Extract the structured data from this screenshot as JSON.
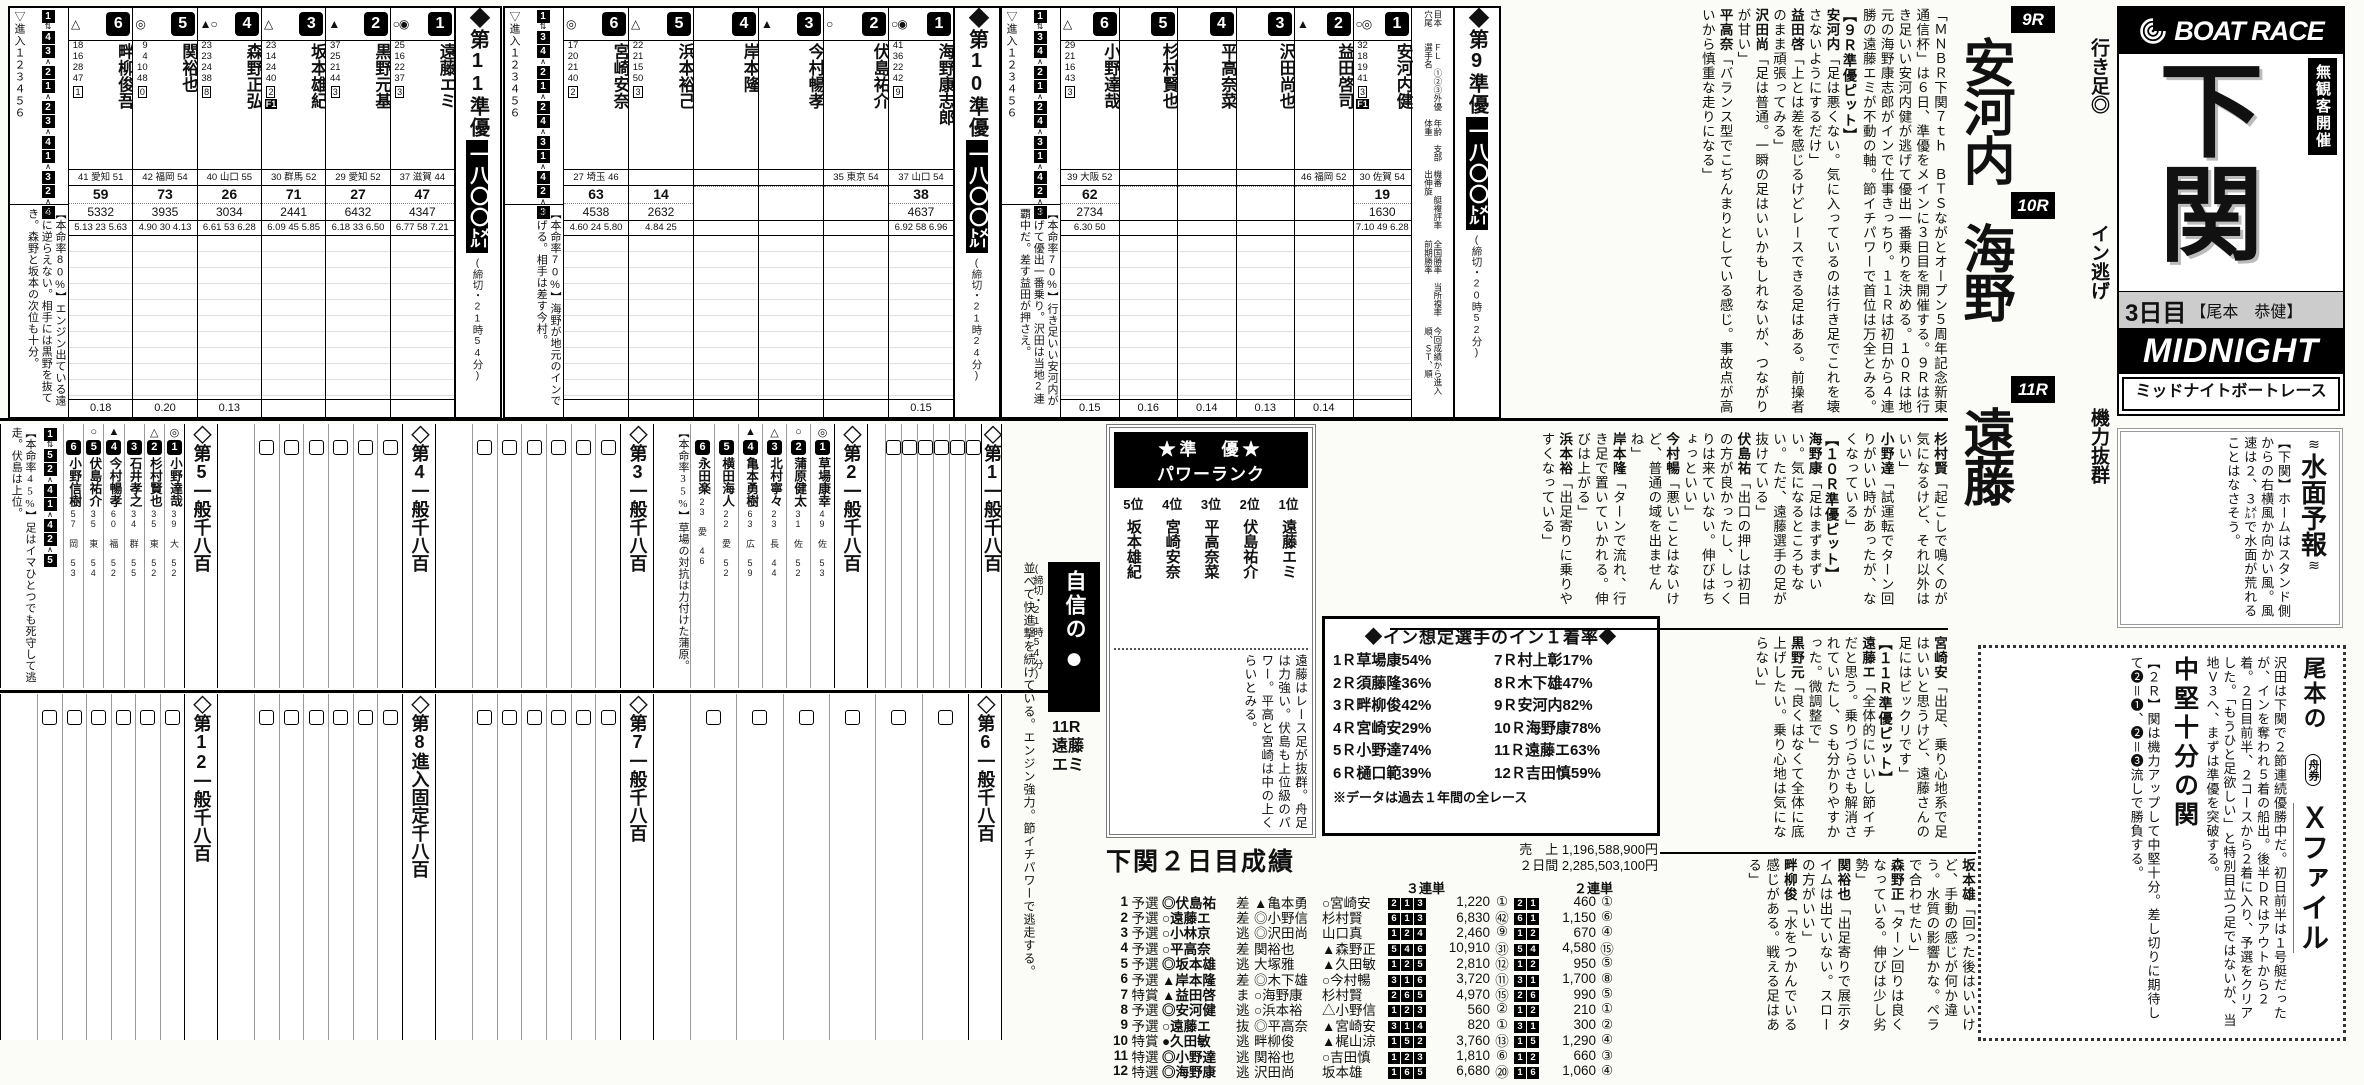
{
  "masthead": {
    "brand": "BOAT RACE",
    "closed_door": "無観客開催",
    "venue": "下関",
    "day": "3日目",
    "byline": "【尾本　恭健】",
    "midnight": "MIDNIGHT",
    "midnight_kana": "ミッドナイトボートレース"
  },
  "headline": {
    "items": [
      {
        "race": "9R",
        "label": "行き足◎",
        "name": "安河内"
      },
      {
        "race": "10R",
        "label": "イン逃げ",
        "name": "海野"
      },
      {
        "race": "11R",
        "label": "機力抜群",
        "name": "遠藤"
      }
    ]
  },
  "lede": "「ＭＮＢＲ下関７ｔｈ　ＢＴＳながとオープン５周年記念新東通信杯」は６日、準優をメインに３日目を開催する。９Ｒは行き足いい安河内健が逃げて優出一番乗りを決める。１０Ｒは地元の海野康志郎がインで仕事きっちり。１１Ｒは初日から４連勝の遠藤エミが不動の軸。節イチパワーで首位は万全とみる。",
  "pit_bands": [
    {
      "items": [
        {
          "q": "lede"
        },
        {
          "h": "【９Ｒ準優ピット】"
        },
        {
          "q": "安河内「足は悪くない。気に入っているのは行き足でこれを壊さないようにするだけ」"
        },
        {
          "q": "益田啓「上とは差を感じるけどレースできる足はある。前操者のまま頑張ってみる」"
        },
        {
          "q": "沢田尚「足は普通。一瞬の足はいいかもしれないが、つながりが甘い」"
        },
        {
          "q": "平高奈「バランス型でこぢんまりとしている感じ。事故点が高いから慎重な走りになる」"
        }
      ]
    },
    {
      "items": [
        {
          "q": "杉村賢「起こしで鳴くのが気になるけど、それ以外はいい」"
        },
        {
          "q": "小野達「試運転でターン回りがいい時があったが、なくなっている」"
        },
        {
          "h": "【１０Ｒ準優ピット】"
        },
        {
          "q": "海野康「足はまずまずいい。気になるところもない。ただ、遠藤選手の足が抜けている」"
        },
        {
          "q": "伏島祐「出口の押しは初日の方が良かったし、しっくりは来ていない。伸びはちょっといい」"
        },
        {
          "q": "今村暢「悪いことはないけど、普通の域を出ませんね」"
        },
        {
          "q": "岸本隆「ターンで流れ、行き足で置いていかれる。伸びは上がる」"
        },
        {
          "q": "浜本裕「出足寄りに乗りやすくなっている」"
        }
      ]
    },
    {
      "items": [
        {
          "q": "宮崎安「出足、乗り心地系で足はいいと思うけど、遠藤さんの足にはビックリです」"
        },
        {
          "h": "【１１Ｒ準優ピット】"
        },
        {
          "q": "遠藤エ「全体的にいいし節イチだと思う。乗りづらさも解消されていたし、Ｓも分かりやすかった。微調整で」"
        },
        {
          "q": "黒野元「良くはなくて全体に底上げしたい。乗り心地は気にならない」"
        }
      ]
    },
    {
      "items": [
        {
          "q": "坂本雄「回った後はいいけど、手動の感じが何か違う。水質の影響かな。ペラで合わせたい」"
        },
        {
          "q": "森野正「ターン回りは良くなっている。伸びは少し劣勢」"
        },
        {
          "q": "関裕也「出足寄りで展示タイムは出ていない。スローの方がいい」"
        },
        {
          "q": "畔柳俊「水をつかんでいる感じがある。戦える足はある」"
        }
      ]
    }
  ],
  "legend": [
    "目本　穴尾",
    "ＦＬ　①②③外優　選手名",
    "年齢　支部　体重",
    "機番　艇複評率　出伸旋",
    "全国勝率　当所複率　前期勝率",
    "今回成績から進入順、ＳＴ、順"
  ],
  "entry_label": "▽進入１２３４５６",
  "cards": [
    {
      "title": "◆第11準優",
      "dist": "一八〇〇㍍",
      "deadline": "(締切・21時54分)",
      "comment": "【本命率80%】エンジン出ている遠藤に逆らえない。相手には黒野を抜てき。森野と坂本の次位も十分。",
      "pairs": [
        [
          1,
          4
        ],
        [
          3,
          2
        ],
        [
          1,
          2
        ],
        [
          3,
          4
        ],
        [
          1,
          3
        ],
        [
          2,
          4
        ]
      ],
      "racers": [
        {
          "n": 6,
          "mk": "△",
          "nm": "畔柳俊吾",
          "rc": "18 16 28 47",
          "fl": "1",
          "info": "41 愛知 51",
          "s1": "59",
          "s2": "5332",
          "rt": "5.13 23 5.63",
          "st": "0.18"
        },
        {
          "n": 5,
          "mk": "◎",
          "nm": "関裕也",
          "rc": "9 4 10 48",
          "fl": "0",
          "info": "42 福岡 54",
          "s1": "73",
          "s2": "3935",
          "rt": "4.90 30 4.13",
          "st": "0.20"
        },
        {
          "n": 4,
          "mk": "▲○",
          "nm": "森野正弘",
          "rc": "23 23 24 38",
          "fl": "8",
          "info": "40 山口 55",
          "s1": "26",
          "s2": "3034",
          "rt": "6.61 53 6.28",
          "st": "0.13"
        },
        {
          "n": 3,
          "mk": "△",
          "nm": "坂本雄紀",
          "rc": "23 14 24 40",
          "fl": "2",
          "flag": "F1",
          "info": "30 群馬 52",
          "s1": "71",
          "s2": "2441",
          "rt": "6.09 45 5.85",
          "st": ""
        },
        {
          "n": 2,
          "mk": "▲",
          "nm": "黒野元基",
          "rc": "37 25 21 44",
          "fl": "3",
          "info": "29 愛知 52",
          "s1": "27",
          "s2": "6432",
          "rt": "6.18 33 6.50",
          "st": ""
        },
        {
          "n": 1,
          "mk": "○◉",
          "nm": "遠藤エミ",
          "rc": "25 16 22 37",
          "fl": "3",
          "info": "37 滋賀 44",
          "s1": "47",
          "s2": "4347",
          "rt": "6.77 58 7.21",
          "st": ""
        }
      ]
    },
    {
      "title": "◆第10準優",
      "dist": "一八〇〇㍍",
      "deadline": "(締切・21時24分)",
      "comment": "【本命率70%】海野が地元のインで逃げる。相手は差す今村。",
      "pairs": [
        [
          1,
          3
        ],
        [
          4,
          2
        ],
        [
          1,
          2
        ],
        [
          4,
          3
        ],
        [
          1,
          4
        ],
        [
          2,
          3
        ]
      ],
      "racers": [
        {
          "n": 6,
          "mk": "◎",
          "nm": "宮崎安奈",
          "rc": "17 20 21 40",
          "fl": "2",
          "info": "27 埼玉 46",
          "s1": "63",
          "s2": "4538",
          "rt": "4.60 24 5.80",
          "st": ""
        },
        {
          "n": 5,
          "mk": "△",
          "nm": "浜本裕己",
          "rc": "22 21 15 50",
          "fl": "3",
          "info": "",
          "s1": "14",
          "s2": "2632",
          "rt": "4.84 25",
          "st": ""
        },
        {
          "n": 4,
          "mk": "",
          "nm": "岸本隆",
          "rc": "",
          "fl": "",
          "info": "",
          "s1": "",
          "s2": "",
          "rt": "",
          "st": ""
        },
        {
          "n": 3,
          "mk": "▲",
          "nm": "今村暢孝",
          "rc": "",
          "fl": "",
          "info": "",
          "s1": "",
          "s2": "",
          "rt": "",
          "st": ""
        },
        {
          "n": 2,
          "mk": "○",
          "nm": "伏島祐介",
          "rc": "",
          "fl": "",
          "info": "35 東京 54",
          "s1": "",
          "s2": "",
          "rt": "",
          "st": ""
        },
        {
          "n": 1,
          "mk": "○◉",
          "nm": "海野康志郎",
          "rc": "41 36 22 42",
          "fl": "9",
          "info": "37 山口 54",
          "s1": "38",
          "s2": "4637",
          "rt": "6.92 58 6.96",
          "st": "0.15"
        }
      ]
    },
    {
      "title": "◆第9準優",
      "dist": "一八〇〇㍍",
      "deadline": "(締切・20時52分)",
      "comment": "【本命率70%】行き足いい安河内が逃げて優出一番乗り。沢田は当地2連覇中だ。差す益田が押さえ。",
      "pairs": [
        [
          1,
          3
        ],
        [
          4,
          2
        ],
        [
          1,
          2
        ],
        [
          4,
          3
        ],
        [
          1,
          4
        ],
        [
          2,
          3
        ]
      ],
      "racers": [
        {
          "n": 6,
          "mk": "△",
          "nm": "小野達哉",
          "rc": "29 21 16 43",
          "fl": "3",
          "info": "39 大阪 52",
          "s1": "62",
          "s2": "2734",
          "rt": "6.30 50",
          "st": "0.15"
        },
        {
          "n": 5,
          "mk": "",
          "nm": "杉村賢也",
          "rc": "",
          "fl": "",
          "info": "",
          "s1": "",
          "s2": "",
          "rt": "",
          "st": "0.16"
        },
        {
          "n": 4,
          "mk": "",
          "nm": "平高奈菜",
          "rc": "",
          "fl": "",
          "info": "",
          "s1": "",
          "s2": "",
          "rt": "",
          "st": "0.14"
        },
        {
          "n": 3,
          "mk": "",
          "nm": "沢田尚也",
          "rc": "",
          "fl": "",
          "info": "",
          "s1": "",
          "s2": "",
          "rt": "",
          "st": "0.13"
        },
        {
          "n": 2,
          "mk": "▲",
          "nm": "益田啓司",
          "rc": "",
          "fl": "",
          "info": "46 福岡 52",
          "s1": "",
          "s2": "",
          "rt": "",
          "st": "0.14"
        },
        {
          "n": 1,
          "mk": "○◎",
          "nm": "安河内健",
          "rc": "32 18 19 41",
          "fl": "3",
          "flag": "F1",
          "info": "30 佐賀 54",
          "s1": "19",
          "s2": "1630",
          "rt": "7.10 49 6.28",
          "st": ""
        }
      ]
    }
  ],
  "powerrank": {
    "title1": "★準　優★",
    "title2": "パワーランク",
    "entries": [
      {
        "rank": "1位",
        "name": "遠藤エミ"
      },
      {
        "rank": "2位",
        "name": "伏島祐介"
      },
      {
        "rank": "3位",
        "name": "平高奈菜"
      },
      {
        "rank": "4位",
        "name": "宮崎安奈"
      },
      {
        "rank": "5位",
        "name": "坂本雄紀"
      }
    ],
    "note": "遠藤はレース足が抜群。舟足は力強い。伏島も上位級のパワー。平高と宮崎は中の上くらいとみる。"
  },
  "inrate": {
    "title": "◆イン想定選手のイン１着率◆",
    "left": [
      "1Ｒ草場康54%",
      "2Ｒ須藤隆36%",
      "3Ｒ畔柳俊42%",
      "4Ｒ宮崎安29%",
      "5Ｒ小野達74%",
      "6Ｒ樋口範39%"
    ],
    "right": [
      "7Ｒ村上彰17%",
      "8Ｒ木下雄47%",
      "9Ｒ安河内82%",
      "10Ｒ海野康78%",
      "11Ｒ遠藤エ63%",
      "12Ｒ吉田慎59%"
    ],
    "note": "※データは過去１年間の全レース"
  },
  "results": {
    "title": "下関２日目成績",
    "sales": [
      "売　上 1,196,588,900円",
      "２日間 2,285,503,100円"
    ],
    "tan_label": "３連単",
    "ni_label": "２連単",
    "rows": [
      {
        "r": "1",
        "cls": "予選",
        "w1": "◎伏島祐",
        "k": "差",
        "w2": "▲亀本勇",
        "w3": "○宮崎安",
        "t": "2-1-3",
        "tp": "1,220",
        "tn": "①",
        "d": "2-1",
        "dp": "460",
        "dn": "①"
      },
      {
        "r": "2",
        "cls": "予選",
        "w1": "○遠藤エ",
        "k": "差",
        "w2": "◎小野信",
        "w3": "杉村賢",
        "t": "6-1-3",
        "tp": "6,830",
        "tn": "㊷",
        "d": "6-1",
        "dp": "1,150",
        "dn": "⑥"
      },
      {
        "r": "3",
        "cls": "予選",
        "w1": "○小林京",
        "k": "逃",
        "w2": "◎沢田尚",
        "w3": "山口真",
        "t": "1-2-4",
        "tp": "2,460",
        "tn": "⑨",
        "d": "1-2",
        "dp": "670",
        "dn": "④"
      },
      {
        "r": "4",
        "cls": "予選",
        "w1": "○平高奈",
        "k": "差",
        "w2": "関裕也",
        "w3": "▲森野正",
        "t": "5-4-6",
        "tp": "10,910",
        "tn": "㉛",
        "d": "5-4",
        "dp": "4,580",
        "dn": "⑮"
      },
      {
        "r": "5",
        "cls": "予選",
        "w1": "◎坂本雄",
        "k": "逃",
        "w2": "大塚雅",
        "w3": "▲久田敏",
        "t": "1-2-5",
        "tp": "2,810",
        "tn": "⑫",
        "d": "1-2",
        "dp": "950",
        "dn": "⑤"
      },
      {
        "r": "6",
        "cls": "予選",
        "w1": "▲岸本隆",
        "k": "差",
        "w2": "◎木下雄",
        "w3": "○今村暢",
        "t": "3-1-6",
        "tp": "3,720",
        "tn": "⑪",
        "d": "3-1",
        "dp": "1,700",
        "dn": "⑧"
      },
      {
        "r": "7",
        "cls": "特賞",
        "w1": "▲益田啓",
        "k": "ま",
        "w2": "○海野康",
        "w3": "杉村賢",
        "t": "2-6-5",
        "tp": "4,970",
        "tn": "⑮",
        "d": "2-6",
        "dp": "990",
        "dn": "⑤"
      },
      {
        "r": "8",
        "cls": "予選",
        "w1": "◎安河健",
        "k": "逃",
        "w2": "○浜本裕",
        "w3": "△小野信",
        "t": "1-2-3",
        "tp": "560",
        "tn": "②",
        "d": "1-2",
        "dp": "210",
        "dn": "①"
      },
      {
        "r": "9",
        "cls": "予選",
        "w1": "○遠藤エ",
        "k": "抜",
        "w2": "◎平高奈",
        "w3": "▲宮崎安",
        "t": "3-1-4",
        "tp": "820",
        "tn": "①",
        "d": "3-1",
        "dp": "300",
        "dn": "②"
      },
      {
        "r": "10",
        "cls": "特賞",
        "w1": "●久田敏",
        "k": "逃",
        "w2": "畔柳俊",
        "w3": "▲梶山涼",
        "t": "1-5-2",
        "tp": "3,760",
        "tn": "⑬",
        "d": "1-5",
        "dp": "1,290",
        "dn": "④"
      },
      {
        "r": "11",
        "cls": "特選",
        "w1": "◎小野達",
        "k": "逃",
        "w2": "関裕也",
        "w3": "○吉田慎",
        "t": "1-2-3",
        "tp": "1,810",
        "tn": "⑥",
        "d": "1-2",
        "dp": "660",
        "dn": "③"
      },
      {
        "r": "12",
        "cls": "特選",
        "w1": "◎海野康",
        "k": "逃",
        "w2": "沢田尚",
        "w3": "坂本雄",
        "t": "1-6-5",
        "tp": "6,680",
        "tn": "⑳",
        "d": "1-6",
        "dp": "1,060",
        "dn": "④"
      }
    ]
  },
  "forecast": {
    "title": "水面予報",
    "body": "【下関】ホームはスタンド側からの右横風か向かい風。風速は２、３㍍で水面が荒れることはなさそう。"
  },
  "xfile": {
    "author": "尾本の",
    "badge": "舟券",
    "title": "Ｘファイル",
    "body": "沢田は下関で２節連続優勝中だ。初日前半は１号艇だったが、インを奪われ５着の船出。後半ＤＲはアウトから２着。２日目前半、２コースから２着に入り、予選をクリアした。「もうひと足欲しい」と特別目立つ足ではないが、当地Ｖ３へ、まずは準優を突破する。",
    "subhead": "中堅十分の関",
    "body2": "【２Ｒ】関は機力アップして中堅十分。差し切りに期待して❷＝❶、❷＝❸流しで勝負する。"
  },
  "confidence": {
    "banner": "自信の",
    "mark": "●",
    "deadline": "(締切・21時54分)",
    "race": "11R",
    "name": "遠藤エミ",
    "body": "並べて快進撃を続けている。エンジン強力。節イチパワーで逃走する。"
  },
  "previews": [
    {
      "no": 5,
      "title": "◇第5一般千八百",
      "comment": "【本命率45%】足はイマひとつでも死守して逃走。伏島は上位。",
      "pairs": [
        [
          1,
          5
        ],
        [
          2,
          4
        ],
        [
          1,
          4
        ],
        [
          2,
          5
        ]
      ],
      "racers": [
        {
          "n": 1,
          "mk": "◎",
          "nm": "小野達哉",
          "info": "39 大 52"
        },
        {
          "n": 2,
          "mk": "△",
          "nm": "杉村賢也",
          "info": "35 東 52"
        },
        {
          "n": 3,
          "mk": "",
          "nm": "石井孝之",
          "info": "34 群 55"
        },
        {
          "n": 4,
          "mk": "▲",
          "nm": "今村暢孝",
          "info": "60 福 52"
        },
        {
          "n": 5,
          "mk": "○",
          "nm": "伏島祐介",
          "info": "35 東 54"
        },
        {
          "n": 6,
          "mk": "",
          "nm": "小野信樹",
          "info": "57 岡 53"
        }
      ]
    },
    {
      "no": 4,
      "title": "◇第4一般千八百"
    },
    {
      "no": 3,
      "title": "◇第3一般千八百"
    },
    {
      "no": 2,
      "title": "◇第2一般千八百",
      "comment": "【本命率35%】草場の対抗は力付けた蒲原。",
      "racers": [
        {
          "n": 1,
          "mk": "◎",
          "nm": "草場康幸",
          "info": "49 佐 53"
        },
        {
          "n": 2,
          "mk": "○",
          "nm": "蒲原健太",
          "info": "31 佐 52"
        },
        {
          "n": 3,
          "mk": "△",
          "nm": "北村寧々",
          "info": "23 長 44"
        },
        {
          "n": 4,
          "mk": "▲",
          "nm": "亀本勇樹",
          "info": "63 広 59"
        },
        {
          "n": 5,
          "mk": "",
          "nm": "横田海人",
          "info": "22 愛 52"
        },
        {
          "n": 6,
          "mk": "",
          "nm": "永田楽",
          "info": "23 愛 46"
        }
      ]
    },
    {
      "no": 1,
      "title": "◇第1一般千八百"
    },
    {
      "no": 12,
      "title": "◇第12一般千八百"
    },
    {
      "no": 8,
      "title": "◇第8進入固定千八百"
    },
    {
      "no": 7,
      "title": "◇第7一般千八百"
    },
    {
      "no": 6,
      "title": "◇第6一般千八百"
    }
  ]
}
